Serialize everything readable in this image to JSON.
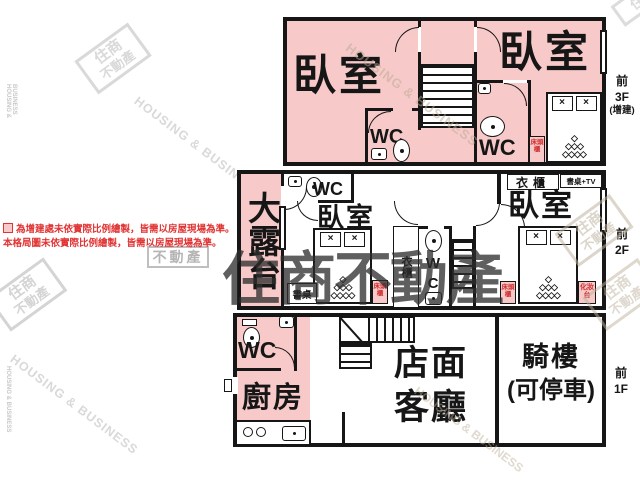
{
  "colors": {
    "addition_pink": "#f7c9c9",
    "wall_black": "#161616",
    "room_label_red": "#d03030",
    "annotation_red": "#e13434",
    "watermark_light_gray": "#d9d9d9",
    "watermark_tan": "#cbbfae",
    "watermark_dark": "#2e2e2e"
  },
  "legend": {
    "line1": "為增建處未依實際比例繪製，皆需以房屋現場為準。",
    "line2": "本格局圖未依實際比例繪製，皆需以房屋現場為準。"
  },
  "watermark": {
    "en": "HOUSING & BUSINESS",
    "logo_line1": "住商",
    "logo_line2": "不動產",
    "brand_dark": "住商不動產",
    "boxed": "不動產"
  },
  "floor3": {
    "side": [
      "前",
      "3F",
      "(增建)"
    ],
    "bedroom_left": "臥室",
    "bedroom_right": "臥室",
    "wc_left": "WC",
    "wc_right": "WC",
    "bedside": "床頭櫃"
  },
  "floor2": {
    "side": [
      "前",
      "2F"
    ],
    "terrace": "大露台",
    "wc_left": "WC",
    "bedroom_left": "臥室",
    "desk": "書桌",
    "bedside_left": "床頭櫃",
    "wardrobe_mid": "衣櫃",
    "wc_mid": "WC",
    "wardrobe_top": "衣櫃",
    "desk_tv": "書桌+TV",
    "bedroom_right": "臥室",
    "bedside_right": "床頭櫃",
    "vanity": "化妝台"
  },
  "floor1": {
    "side": [
      "前",
      "1F"
    ],
    "wc": "WC",
    "kitchen": "廚房",
    "shop_line1": "店面",
    "shop_line2": "客廳",
    "arcade_line1": "騎樓",
    "arcade_line2": "(可停車)"
  },
  "icons": {
    "pillow": "×",
    "bed_rows": [
      "◇",
      "◇◇◇",
      "◇◇◇◇"
    ]
  }
}
